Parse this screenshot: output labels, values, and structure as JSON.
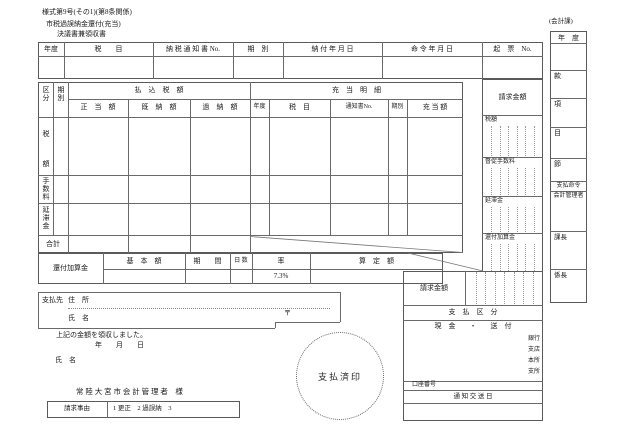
{
  "form": {
    "form_number": "様式第9号(その1)(第8条関係)",
    "title_line1": "市税過誤納金還付(充当)",
    "title_line2": "決議書兼領収書",
    "dept_label": "(会計課)"
  },
  "tableA": {
    "headers": [
      "年度",
      "税　　目",
      "納 税 通 知 書 No.",
      "期　別",
      "納 付 年 月 日",
      "命 令 年 月 日",
      "起　票　No."
    ]
  },
  "tableB": {
    "col_kubun": "区分",
    "col_kibetsu": "期別",
    "group_paid": "払　込　税　額",
    "sub_paid": [
      "正　当　額",
      "既　納　額",
      "過　納　額"
    ],
    "group_juto": "充　当　明　細",
    "sub_juto": [
      "年度",
      "税　目",
      "通知書No.",
      "期別",
      "充 当 額"
    ],
    "row_zeigaku": "税　額",
    "row_tesuryo": "手数料",
    "row_entaikin": "延滞金",
    "row_total": "合計"
  },
  "kasankin_row": {
    "label": "還付加算金",
    "headers": [
      "基　本　額",
      "期　　間",
      "日 数",
      "率",
      "算　定　額"
    ],
    "rate_value": "7.3%"
  },
  "right_panel": {
    "seikyu_label": "請求金額",
    "items": [
      "税額",
      "督促手数料",
      "延滞金",
      "還付加算金"
    ]
  },
  "account_col": {
    "nendo": "年　度",
    "kan": "款",
    "ko": "項",
    "moku": "目",
    "setsu": "節",
    "shiharai_meirei": "支払命令",
    "kaikei_kanrisha": "会計管理者",
    "kacho": "課長",
    "kakaricho": "係長"
  },
  "payee": {
    "label": "支払先",
    "address_label": "住　所",
    "name_label": "氏　名",
    "postal_mark": "〒"
  },
  "receipt": {
    "statement": "上記の金額を領収しました。",
    "date_label": "年　　月　　日",
    "name_label": "氏　名",
    "addressee": "常 陸 大 宮 市 会 計 管 理 者　様"
  },
  "bottom_right": {
    "seikyu_label": "請求金額",
    "shiharai_kubun": "支　払　区　分",
    "cash_send": "現　金　　・　　送　付",
    "bank_labels": [
      "銀行",
      "支店",
      "本所",
      "支所"
    ],
    "koza_label": "口座番号",
    "tsuchi_label": "通 知 交 送 日"
  },
  "stamp": {
    "label": "支払済印"
  },
  "reason": {
    "label": "請求事由",
    "content": "1 更正　2 過誤納　3"
  }
}
